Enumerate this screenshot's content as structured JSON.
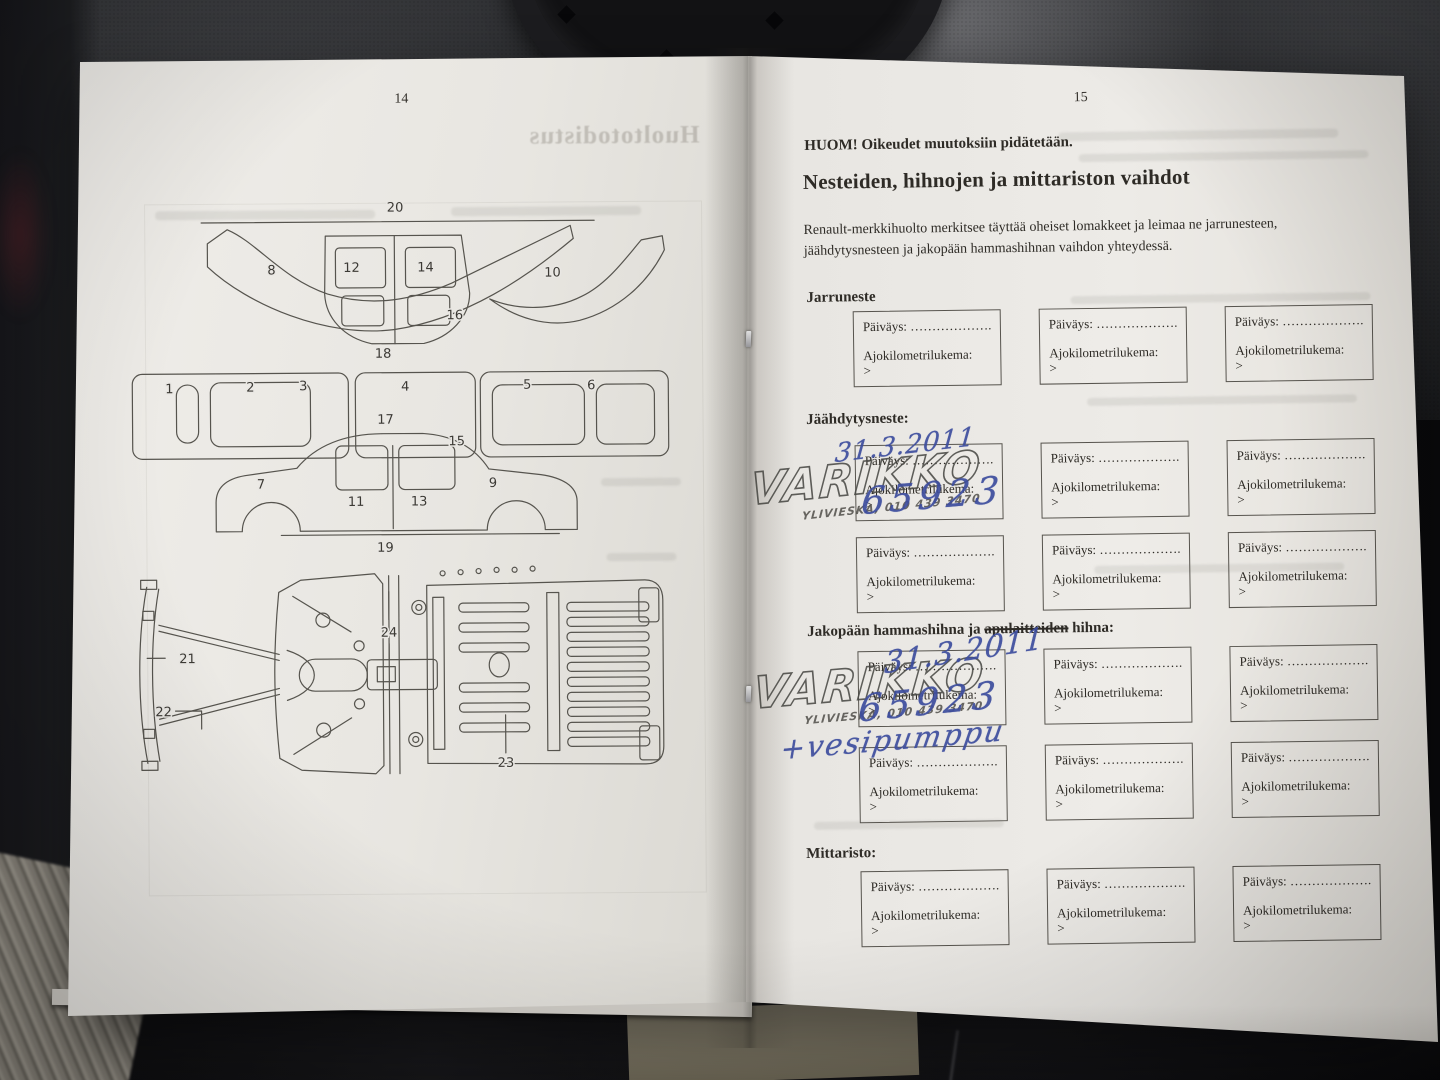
{
  "colors": {
    "paper": "#ebe9e5",
    "handwriting_ink": "#3d4d9e",
    "stamp_ink": "#4a4a46",
    "diagram_ink": "#56544e"
  },
  "left_page": {
    "page_number": "14",
    "ghost_title": "Huoltotodistus",
    "top_labels": [
      "1",
      "2",
      "3",
      "4",
      "5",
      "6",
      "7",
      "8",
      "9",
      "10",
      "11",
      "12",
      "13",
      "14",
      "15",
      "16",
      "17",
      "18",
      "19",
      "20"
    ],
    "bottom_labels": [
      "21",
      "22",
      "23",
      "24"
    ]
  },
  "right_page": {
    "page_number": "15",
    "notice": "HUOM! Oikeudet muutoksiin pidätetään.",
    "title": "Nesteiden, hihnojen ja mittariston vaihdot",
    "intro": "Renault-merkkihuolto merkitsee täyttää oheiset lomakkeet ja leimaa ne jarrunesteen, jäähdytysnesteen ja jakopään hammashihnan vaihdon yhteydessä.",
    "sections": {
      "brake": {
        "heading": "Jarruneste"
      },
      "coolant": {
        "heading": "Jäähdytysneste:"
      },
      "belt": {
        "prefix": "Jakopään hammashihna ja ",
        "struck": "apulaitteiden",
        "suffix": " hihna:"
      },
      "cluster": {
        "heading": "Mittaristo:"
      }
    },
    "box": {
      "date_label": "Päiväys: ………………..",
      "km_label": "Ajokilometrilukema:",
      "km_prompt": ">"
    },
    "stamp": {
      "name": "VARIKKO",
      "detail": "YLIVIESKA, 010 439 3470"
    },
    "handwriting": {
      "coolant_date": "31.3.2011",
      "coolant_km": "65923",
      "belt_date": "31.3.2011",
      "belt_km": "65923",
      "belt_note": "+vesipumppu"
    }
  }
}
